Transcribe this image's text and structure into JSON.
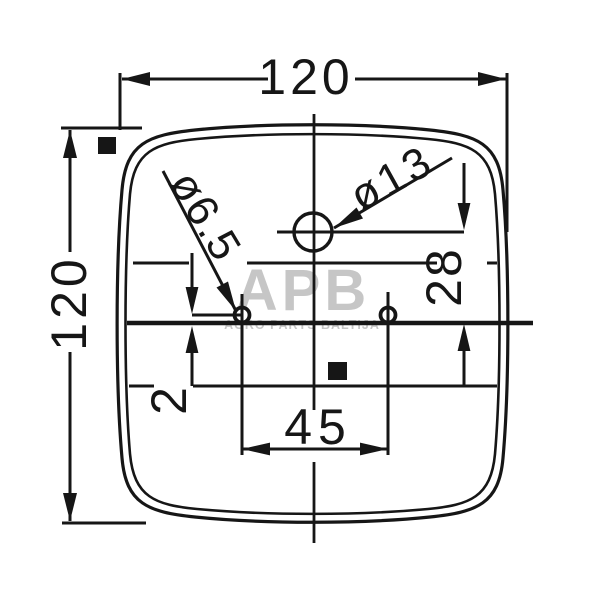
{
  "drawing": {
    "description": "Technical drawing, rear lamp housing, front view with mounting dimensions",
    "labels": {
      "width": "120",
      "height": "120",
      "hole_spacing": "45",
      "big_hole_offset": "28",
      "centerline_offset": "2",
      "big_hole_dia": "ø13",
      "small_hole_dia": "ø6.5"
    },
    "watermark": {
      "logo": "APB",
      "subtitle": "AGRO PARTS BALTIJA"
    },
    "colors": {
      "line": "#161616",
      "watermark": "#c6c6c6",
      "background": "#ffffff"
    }
  }
}
